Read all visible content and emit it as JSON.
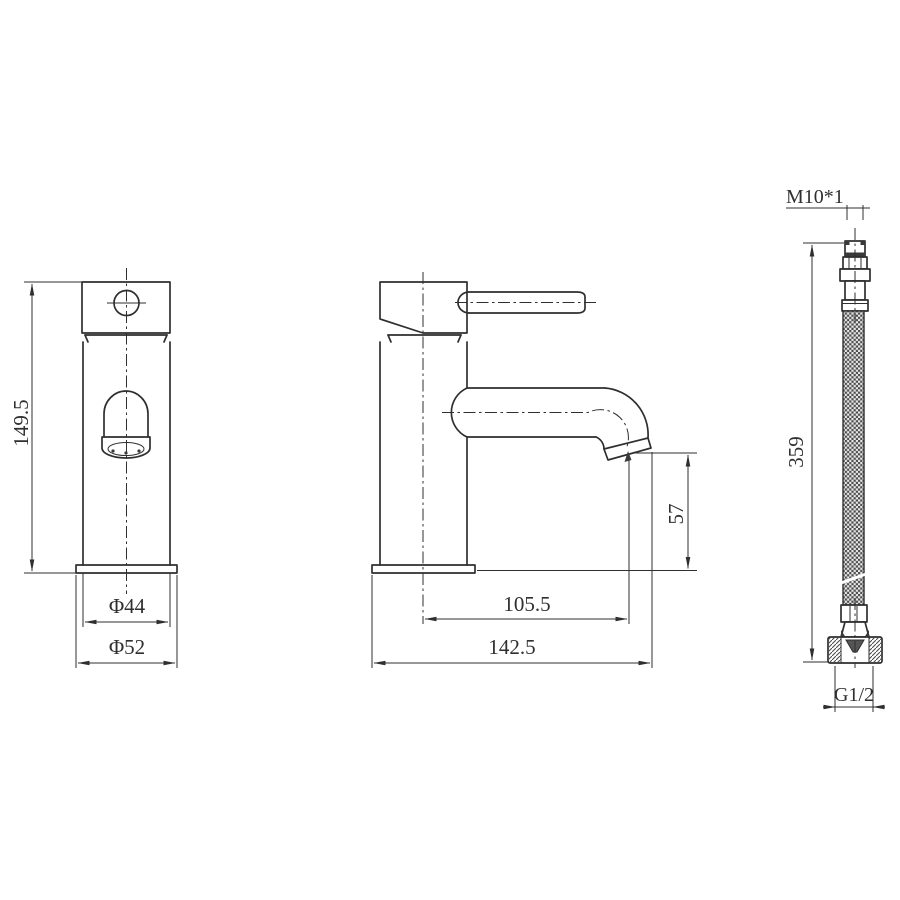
{
  "front_view": {
    "height_label": "149.5",
    "body_diameter_label": "Φ44",
    "base_diameter_label": "Φ52"
  },
  "side_view": {
    "spout_height_label": "57",
    "spout_reach_label": "105.5",
    "overall_depth_label": "142.5"
  },
  "hose_view": {
    "top_thread_label": "M10*1",
    "length_label": "359",
    "bottom_thread_label": "G1/2"
  },
  "colors": {
    "line": "#2f2f2f",
    "background": "#ffffff"
  }
}
